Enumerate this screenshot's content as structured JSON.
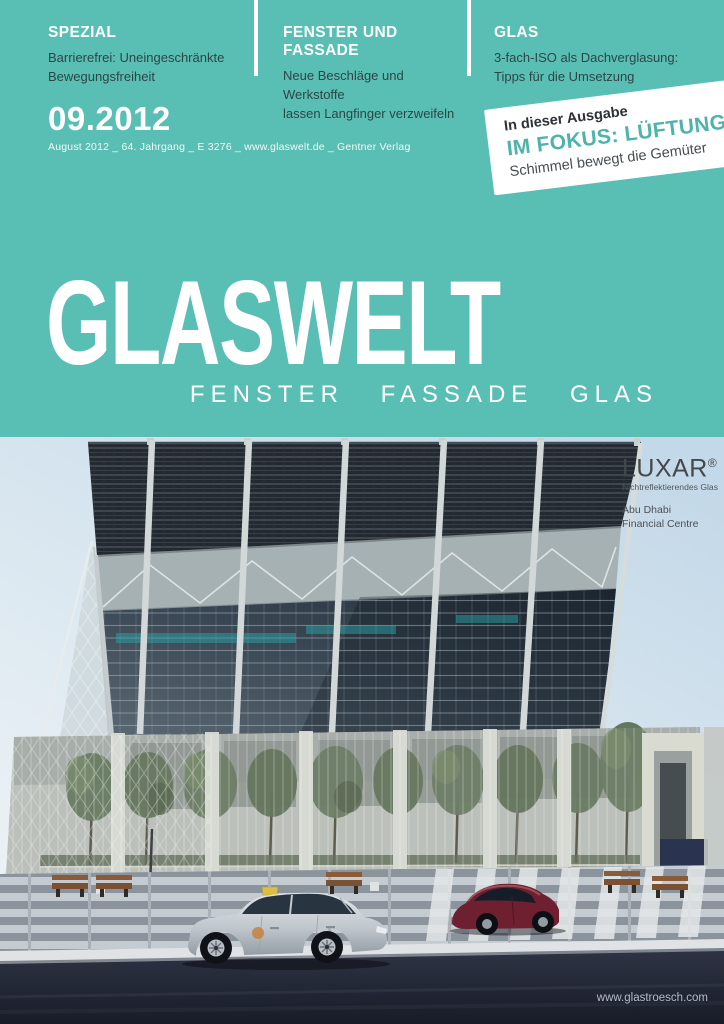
{
  "cover": {
    "topics": [
      {
        "label": "SPEZIAL",
        "line1": "Barrierefrei: Uneingeschränkte",
        "line2": "Bewegungsfreiheit"
      },
      {
        "label": "FENSTER UND FASSADE",
        "line1": "Neue Beschläge und Werkstoffe",
        "line2": "lassen Langfinger verzweifeln"
      },
      {
        "label": "GLAS",
        "line1": "3-fach-ISO als Dachverglasung:",
        "line2": "Tipps für die Umsetzung"
      }
    ],
    "issue": {
      "number": "09.2012",
      "meta": "August 2012 _ 64. Jahrgang _ E 3276 _ www.glaswelt.de _ Gentner Verlag"
    },
    "badge": {
      "kicker": "In dieser Ausgabe",
      "title": "IM FOKUS: LÜFTUNG",
      "subtitle": "Schimmel bewegt die Gemüter"
    },
    "masthead": {
      "title": "GLASWELT",
      "tagline": "FENSTER FASSADE GLAS"
    }
  },
  "photo_ad": {
    "brand": "LUXAR",
    "reg": "®",
    "product": "Nichtreflektierendes Glas",
    "location1": "Abu Dhabi",
    "location2": "Financial Centre",
    "website": "www.glastroesch.com"
  },
  "colors": {
    "teal": "#59beb4",
    "badge-teal": "#4cb4ab",
    "ink": "#2d4646",
    "road": "#252a3a",
    "sky": "#dbe7ef"
  }
}
